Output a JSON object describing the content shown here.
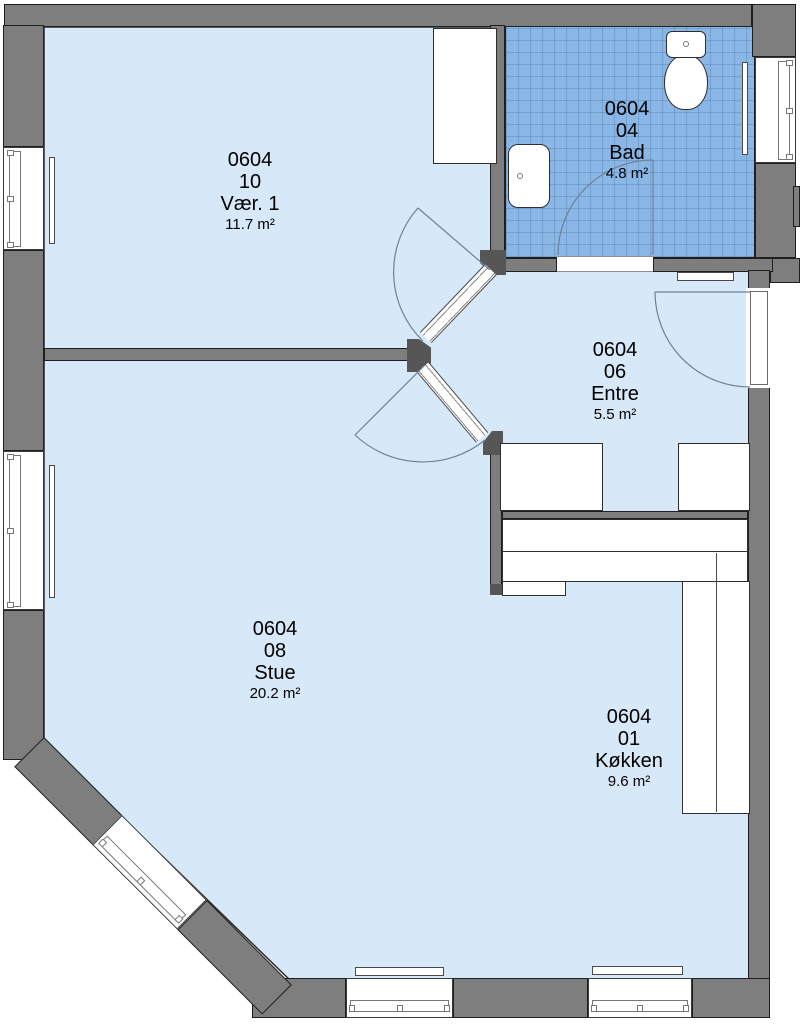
{
  "theme": {
    "wall": "#7e7e7e",
    "edge": "#1f1f1f",
    "cap": "#565656",
    "floor": "#d7e8f8",
    "tile": "#8ab7e6",
    "tileline": "rgba(36,78,128,0.22)",
    "arc": "#6e8296",
    "fix": "#2e2e2e"
  },
  "rooms": [
    {
      "id": "vaer1",
      "unit": "0604",
      "number": "10",
      "name": "Vær. 1",
      "area": "11.7 m²"
    },
    {
      "id": "bad",
      "unit": "0604",
      "number": "04",
      "name": "Bad",
      "area": "4.8 m²"
    },
    {
      "id": "entre",
      "unit": "0604",
      "number": "06",
      "name": "Entre",
      "area": "5.5 m²"
    },
    {
      "id": "stue",
      "unit": "0604",
      "number": "08",
      "name": "Stue",
      "area": "20.2 m²"
    },
    {
      "id": "koekken",
      "unit": "0604",
      "number": "01",
      "name": "Køkken",
      "area": "9.6 m²"
    }
  ]
}
